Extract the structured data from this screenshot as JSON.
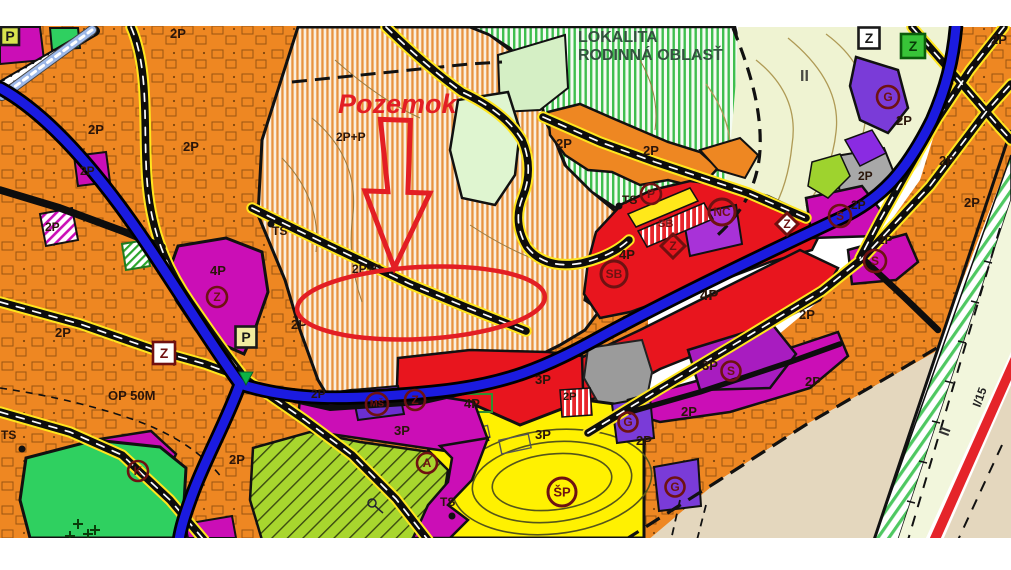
{
  "map": {
    "type": "zoning-plan-map",
    "palette": {
      "orange_zone": "#EE8722",
      "orange_stripe": "#E8933E",
      "green_stripe": "#3FBF4F",
      "pale_green": "#EFF3D2",
      "bright_green": "#2FD060",
      "lime_hatch": "#A8D62E",
      "yellow_zone": "#FFF101",
      "red_zone": "#E8151E",
      "magenta_zone": "#CB0EB6",
      "purple_zone": "#7A3BD8",
      "gray_zone": "#A8A8A8",
      "beige_zone": "#E4D7BE",
      "highway_blue": "#1B1BE0",
      "road_yellow": "#FFE61E",
      "annotation_red": "#E31E24",
      "symbol_maroon": "#6E1212"
    },
    "annotation": {
      "target_label": "Pozemok",
      "color": "#E31E24",
      "marks": [
        "down-arrow-outline",
        "ellipse-outline"
      ]
    },
    "labels": [
      {
        "text": "Pozemok",
        "x": 338,
        "y": 113,
        "size": 27,
        "color": "#E31E24",
        "italic": true
      },
      {
        "text": "LOKALITA",
        "x": 578,
        "y": 42,
        "size": 16,
        "color": "#33523F"
      },
      {
        "text": "RODINNÁ OBLASŤ",
        "x": 578,
        "y": 60,
        "size": 16,
        "color": "#33523F"
      },
      {
        "text": "2P+P",
        "x": 336,
        "y": 141,
        "size": 12
      },
      {
        "text": "2P+P",
        "x": 352,
        "y": 273,
        "size": 12
      },
      {
        "text": "2P",
        "x": 88,
        "y": 134
      },
      {
        "text": "2P",
        "x": 183,
        "y": 151
      },
      {
        "text": "2P",
        "x": 170,
        "y": 38
      },
      {
        "text": "2P",
        "x": 45,
        "y": 231,
        "size": 12
      },
      {
        "text": "2P",
        "x": 80,
        "y": 175,
        "size": 12
      },
      {
        "text": "2P",
        "x": 55,
        "y": 337
      },
      {
        "text": "2P",
        "x": 291,
        "y": 329
      },
      {
        "text": "2P",
        "x": 311,
        "y": 398,
        "size": 12
      },
      {
        "text": "2P",
        "x": 229,
        "y": 464
      },
      {
        "text": "2P",
        "x": 556,
        "y": 148
      },
      {
        "text": "2P",
        "x": 643,
        "y": 155
      },
      {
        "text": "2P",
        "x": 799,
        "y": 319
      },
      {
        "text": "2P",
        "x": 805,
        "y": 386
      },
      {
        "text": "2P",
        "x": 681,
        "y": 416
      },
      {
        "text": "2P",
        "x": 636,
        "y": 445
      },
      {
        "text": "2P",
        "x": 858,
        "y": 180,
        "size": 12
      },
      {
        "text": "2P",
        "x": 896,
        "y": 125
      },
      {
        "text": "2P",
        "x": 939,
        "y": 165
      },
      {
        "text": "2P",
        "x": 851,
        "y": 209,
        "size": 12
      },
      {
        "text": "2P",
        "x": 878,
        "y": 244,
        "size": 12
      },
      {
        "text": "2P",
        "x": 964,
        "y": 207
      },
      {
        "text": "2P",
        "x": 991,
        "y": 44
      },
      {
        "text": "2P",
        "x": 563,
        "y": 400,
        "size": 11
      },
      {
        "text": "4P",
        "x": 210,
        "y": 275
      },
      {
        "text": "4P",
        "x": 619,
        "y": 259
      },
      {
        "text": "4P",
        "x": 700,
        "y": 300,
        "size": 15
      },
      {
        "text": "4P",
        "x": 464,
        "y": 408
      },
      {
        "text": "3P",
        "x": 535,
        "y": 384
      },
      {
        "text": "3P",
        "x": 394,
        "y": 435
      },
      {
        "text": "3P",
        "x": 702,
        "y": 370
      },
      {
        "text": "3P",
        "x": 535,
        "y": 439
      },
      {
        "text": "TS",
        "x": 272,
        "y": 235,
        "size": 12
      },
      {
        "text": "TS",
        "x": 622,
        "y": 204,
        "size": 12
      },
      {
        "text": "TS",
        "x": 1,
        "y": 439,
        "size": 12
      },
      {
        "text": "TS",
        "x": 440,
        "y": 506,
        "size": 12
      },
      {
        "text": "OP 50M",
        "x": 108,
        "y": 400
      },
      {
        "text": "II",
        "x": 800,
        "y": 81,
        "size": 16,
        "color": "#4A4A42"
      },
      {
        "text": "II",
        "x": 948,
        "y": 437,
        "size": 15,
        "color": "#333333",
        "rot": -70
      },
      {
        "text": "I/15",
        "x": 980,
        "y": 408,
        "size": 12,
        "color": "#222222",
        "rot": -70
      },
      {
        "text": "SB",
        "x": 658,
        "y": 227,
        "size": 11,
        "color": "#701010"
      }
    ],
    "symbols": [
      {
        "shape": "circle",
        "letter": "Z",
        "x": 217,
        "y": 297,
        "r": 10
      },
      {
        "shape": "circle",
        "letter": "Z",
        "x": 415,
        "y": 400,
        "r": 10
      },
      {
        "shape": "circle",
        "letter": "MŠ",
        "x": 377,
        "y": 404,
        "r": 11,
        "size": 9.5
      },
      {
        "shape": "circle",
        "letter": "A",
        "x": 427,
        "y": 463,
        "r": 10
      },
      {
        "shape": "circle",
        "letter": "K",
        "x": 138,
        "y": 471,
        "r": 10
      },
      {
        "shape": "circle",
        "letter": "P",
        "x": 651,
        "y": 194,
        "r": 10
      },
      {
        "shape": "circle",
        "letter": "NC",
        "x": 722,
        "y": 212,
        "r": 13,
        "size": 12,
        "sw": 3
      },
      {
        "shape": "circle",
        "letter": "SB",
        "x": 614,
        "y": 274,
        "r": 13,
        "size": 12,
        "sw": 3
      },
      {
        "shape": "circle",
        "letter": "S",
        "x": 731,
        "y": 371,
        "r": 9.5
      },
      {
        "shape": "circle",
        "letter": "S",
        "x": 840,
        "y": 216,
        "r": 11
      },
      {
        "shape": "circle",
        "letter": "S",
        "x": 875,
        "y": 261,
        "r": 11
      },
      {
        "shape": "circle",
        "letter": "G",
        "x": 888,
        "y": 97,
        "r": 11
      },
      {
        "shape": "circle",
        "letter": "G",
        "x": 628,
        "y": 422,
        "r": 9.5
      },
      {
        "shape": "circle",
        "letter": "G",
        "x": 675,
        "y": 487,
        "r": 9.5
      },
      {
        "shape": "circle",
        "letter": "ŠP",
        "x": 562,
        "y": 492,
        "r": 14,
        "size": 13,
        "sw": 3
      },
      {
        "shape": "square",
        "letter": "Z",
        "x": 164,
        "y": 353,
        "s": 22,
        "fill": "#FFFFFF",
        "stroke": "#701010",
        "lc": "#701010"
      },
      {
        "shape": "square",
        "letter": "P",
        "x": 246,
        "y": 337,
        "s": 21,
        "fill": "#F2EDA0",
        "stroke": "#1A1A1A",
        "lc": "#1A1A1A"
      },
      {
        "shape": "square",
        "letter": "Z",
        "x": 869,
        "y": 38,
        "s": 21,
        "fill": "#FFFFFF",
        "stroke": "#1A1A1A",
        "lc": "#1A1A1A"
      },
      {
        "shape": "square",
        "letter": "Z",
        "x": 913,
        "y": 46,
        "s": 24,
        "fill": "#38C438",
        "stroke": "#0B5C0B",
        "lc": "#083C08"
      },
      {
        "shape": "square",
        "letter": "P",
        "x": 10,
        "y": 36,
        "s": 18,
        "fill": "#D9E44E",
        "stroke": "#1A1A1A",
        "lc": "#1A1A1A"
      },
      {
        "shape": "diamond",
        "letter": "Z",
        "x": 673,
        "y": 246,
        "r": 12,
        "fill": "none"
      },
      {
        "shape": "diamond",
        "letter": "Z",
        "x": 787,
        "y": 224,
        "r": 11,
        "fill": "#FFFFFF"
      },
      {
        "shape": "dot",
        "x": 271,
        "y": 224
      },
      {
        "shape": "dot",
        "x": 619,
        "y": 206
      },
      {
        "shape": "dot",
        "x": 22,
        "y": 449
      },
      {
        "shape": "dot",
        "x": 452,
        "y": 516
      },
      {
        "shape": "triangle",
        "x": 246,
        "y": 378,
        "fill": "#0CB344"
      },
      {
        "shape": "plus",
        "x": 78,
        "y": 524
      },
      {
        "shape": "plus",
        "x": 95,
        "y": 530
      },
      {
        "shape": "plus",
        "x": 70,
        "y": 536
      },
      {
        "shape": "plus",
        "x": 88,
        "y": 534
      }
    ]
  }
}
